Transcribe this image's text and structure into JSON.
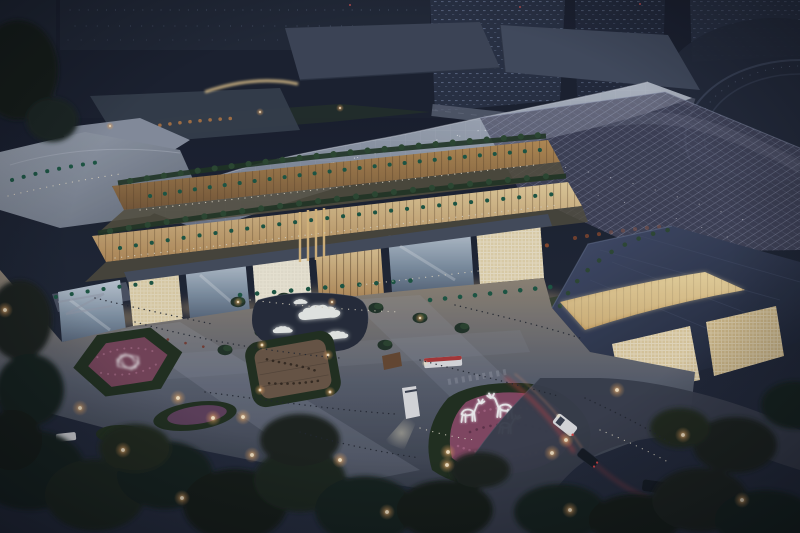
{
  "scene": {
    "title": "Aerial dusk rendering of an illuminated open-air shopping mall complex",
    "setting": "Night aerial view: terraced retail buildings with warm glowing interiors, curved grid-shell roofs, rooftop cafe terraces, a central landscaped plaza, dark city towers behind and lamp-lit street trees in front",
    "landmarks": {
      "city_skyline": "dark high-rise towers with faint lit windows",
      "main_canopy": "curved light-gray grid-shell roof over the mall",
      "glass_canopy": "translucent glass atrium canopy on the east wing",
      "terraces": "stepped dining terraces with green and red cafe umbrellas",
      "storefronts": "glowing glass and timber-lattice storefronts",
      "cloud_pond": "white cloud-shaped sculptures glowing in a reflecting pond",
      "sunken_courtyard": "hedge-ringed sunken timber courtyard with diners",
      "hexagon_garden": "hexagonal parterre garden with a white pavilion sculpture",
      "deer_garden": "triangular flower bed with glowing wireframe deer sculptures",
      "streets": "roads with cars, headlight beams and red tail-light trails",
      "perimeter": "dark street trees dotted with warm park lamps"
    },
    "counts": {
      "deer_sculptures": 3,
      "cloud_sculptures": 4
    },
    "palette": {
      "sky_top": "#141927",
      "city_tower": "#2a3144",
      "canopy_light": "#aeb6c4",
      "warm_glow": "#f0d9a6",
      "roof_slate": "#333b52",
      "terrace_green": "#2d4a31",
      "umbrella_green": "#1e5a44",
      "umbrella_red": "#8e4a2c",
      "plaza_warm": "#a2937d",
      "plaza_cool": "#3f4554",
      "pond": "#262c3a",
      "cloud_white": "#f4f6f2",
      "hedge_dark": "#22301f",
      "flower_pink": "#8a4a66",
      "flower_light": "#b06a8a",
      "wood_deck": "#6e5947",
      "tree_dark": "#18211a",
      "lamp_glow": "#ffcf8e",
      "lamp_core": "#ffeccb",
      "road": "#3a404d",
      "taillight_red": "#e04545",
      "headlight": "#fff3d0",
      "car_white": "#e6e6e8",
      "car_dark": "#161b23",
      "deer_white": "#ffffff"
    }
  }
}
